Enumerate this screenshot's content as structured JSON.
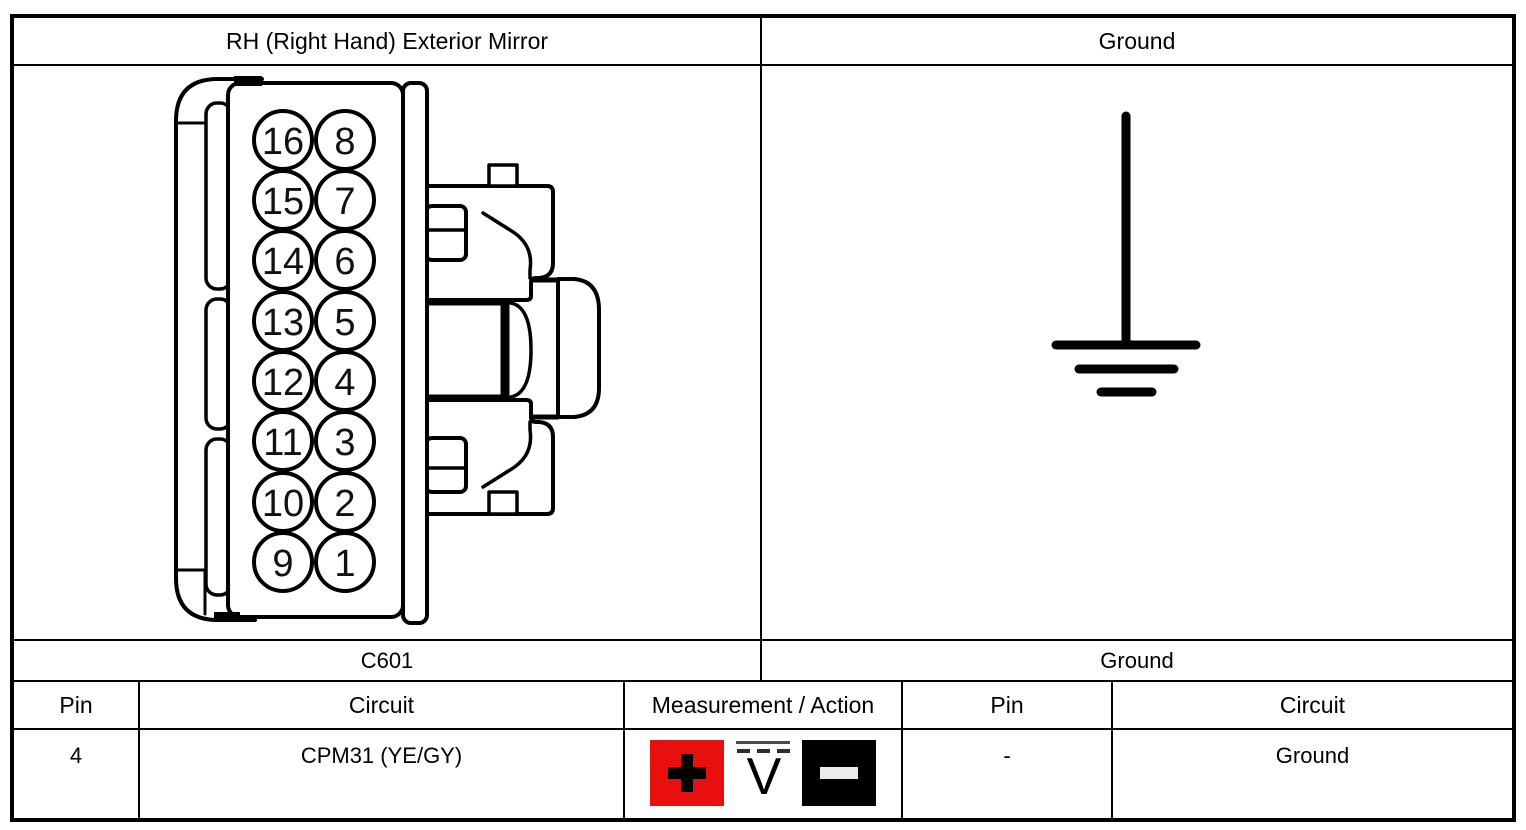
{
  "window": {
    "background": "#ffffff",
    "line_color": "#000000"
  },
  "header": {
    "left_title": "RH (Right Hand) Exterior Mirror",
    "right_title": "Ground"
  },
  "connector": {
    "caption": "C601",
    "left_column_pins": [
      "16",
      "15",
      "14",
      "13",
      "12",
      "11",
      "10",
      "9"
    ],
    "right_column_pins": [
      "8",
      "7",
      "6",
      "5",
      "4",
      "3",
      "2",
      "1"
    ]
  },
  "ground_diagram": {
    "caption": "Ground",
    "symbol": "ground-symbol"
  },
  "pin_table": {
    "headers": {
      "pin": "Pin",
      "circuit": "Circuit",
      "measurement": "Measurement / Action",
      "pin2": "Pin",
      "circuit2": "Circuit"
    },
    "row": {
      "pin": "4",
      "circuit": "CPM31 (YE/GY)",
      "measurement": {
        "positive_icon": "plus-icon",
        "meter_icon": "dc-voltmeter-icon",
        "meter_label": "V",
        "negative_icon": "minus-icon",
        "positive_color": "#e8100c",
        "negative_color": "#000000"
      },
      "ground_pin": "-",
      "ground_circuit": "Ground"
    }
  }
}
